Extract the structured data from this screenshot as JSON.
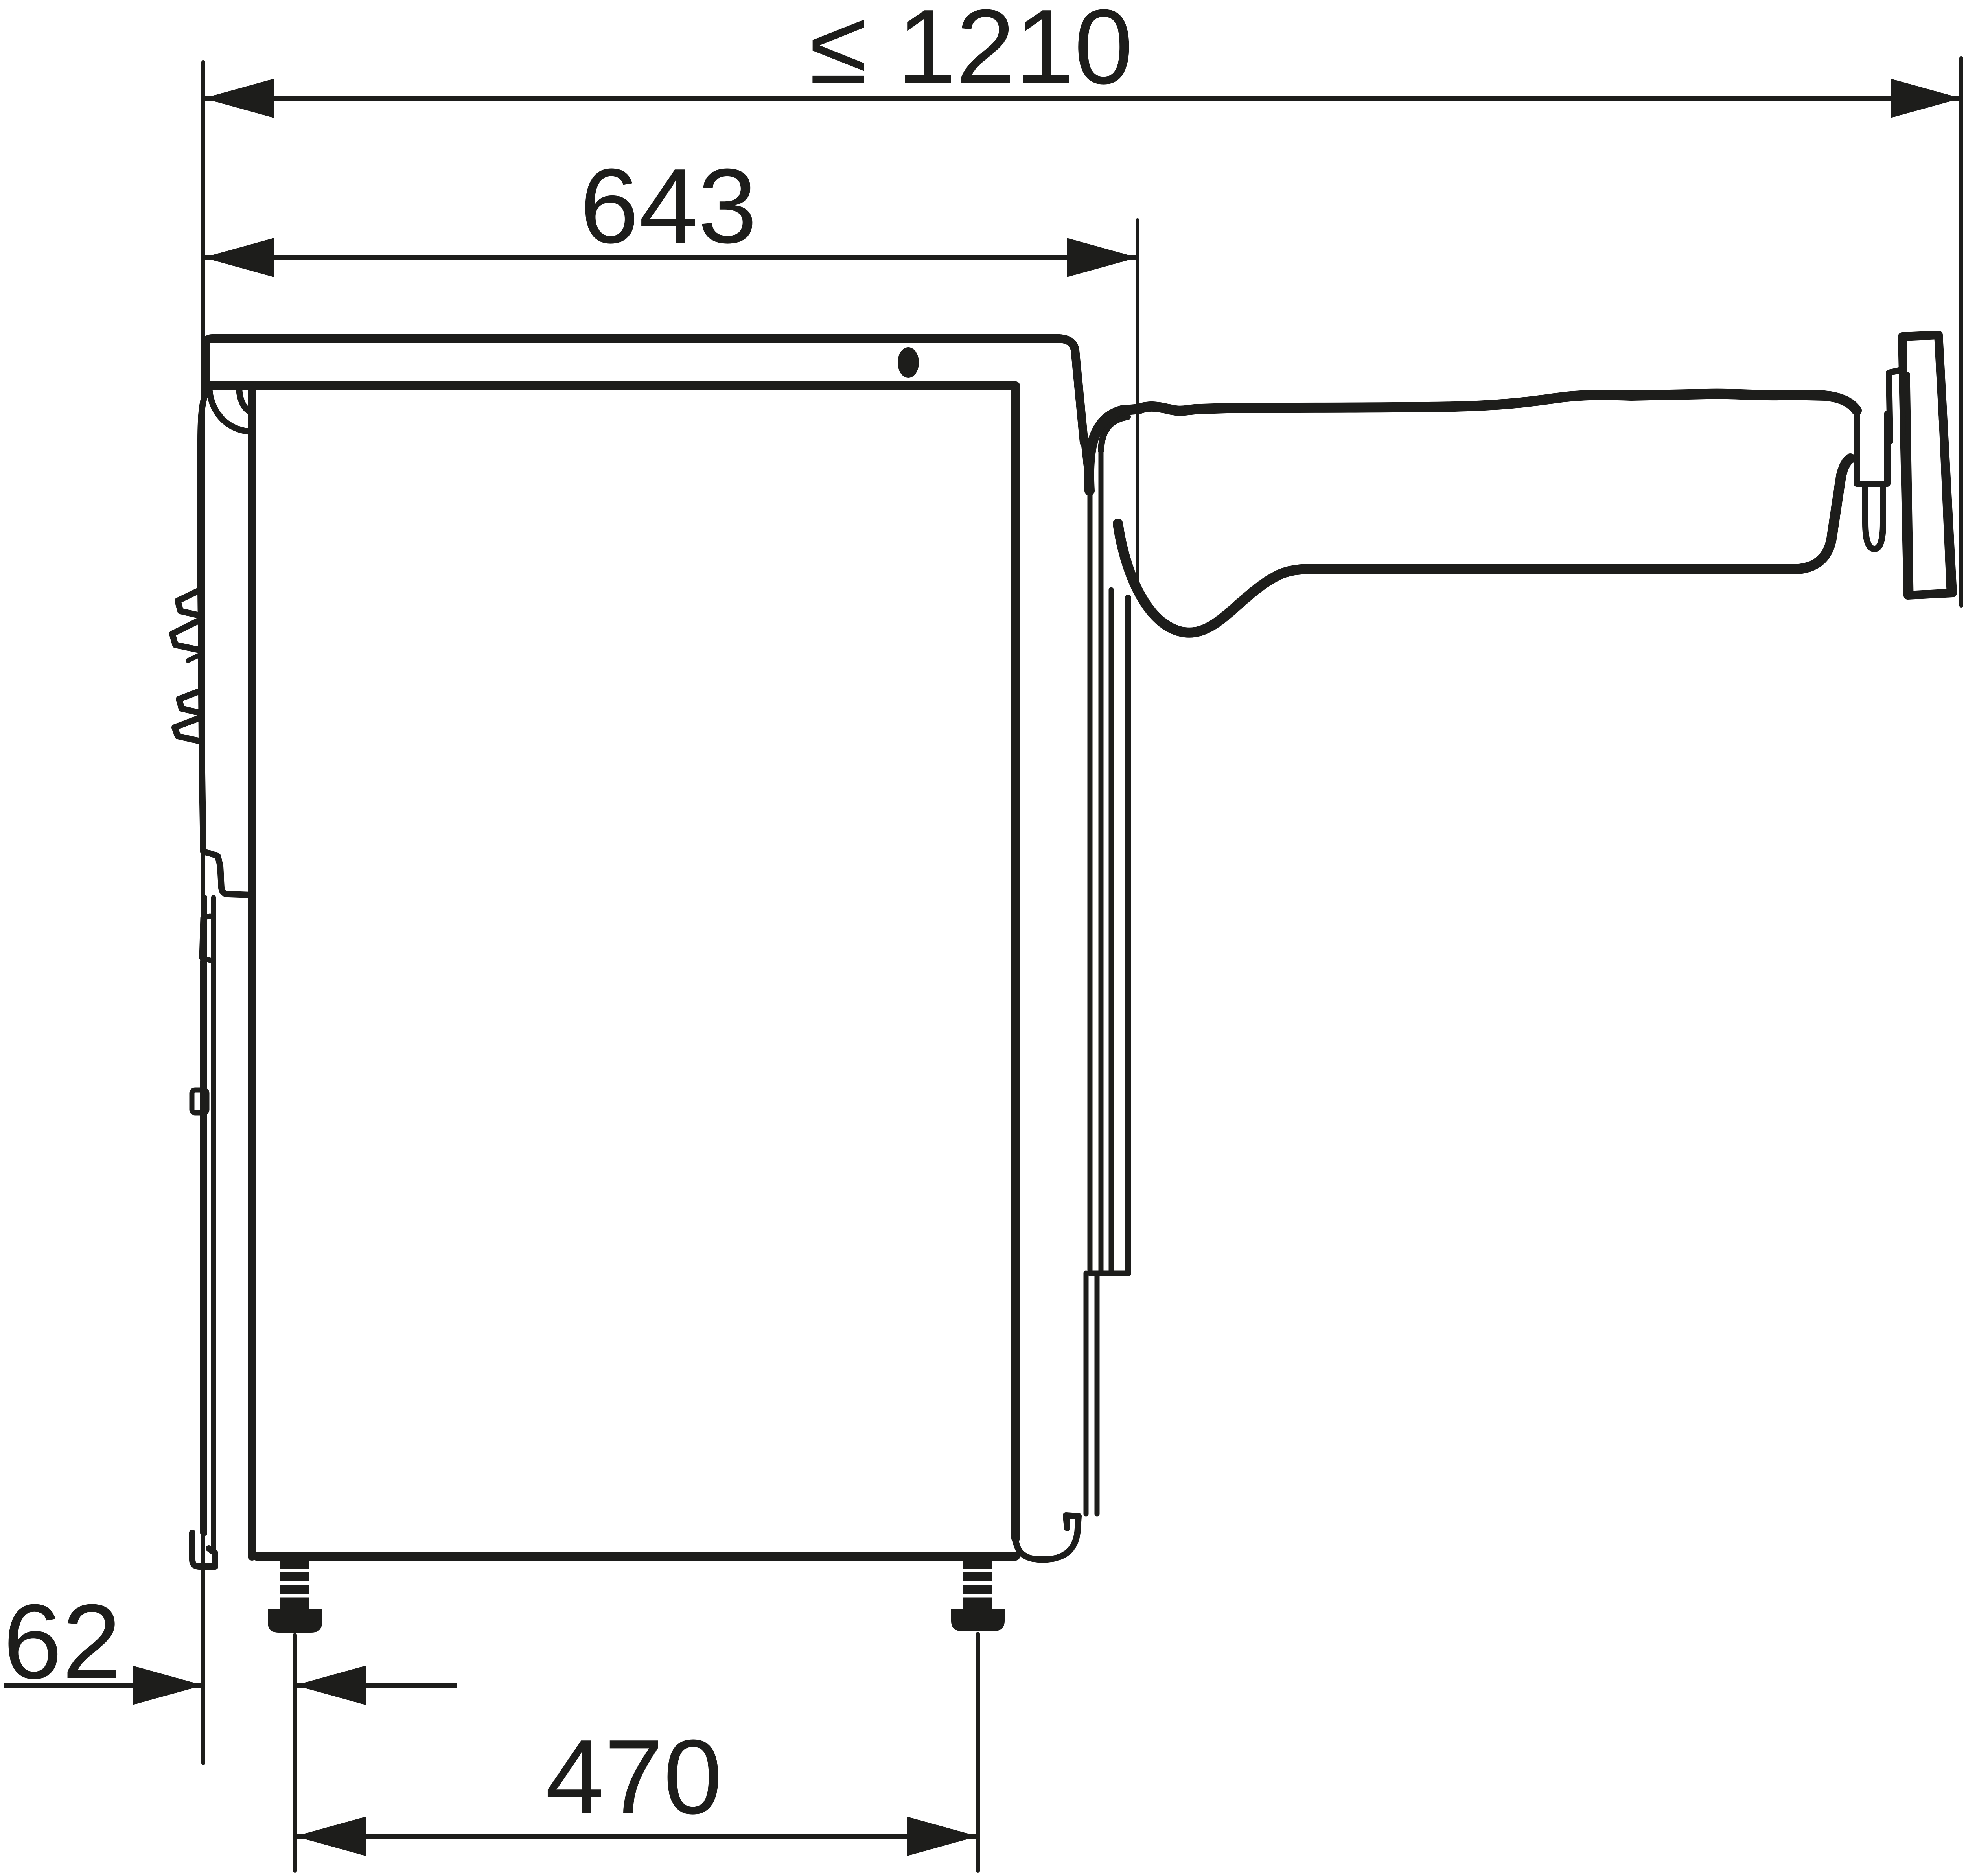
{
  "diagram": {
    "kind": "technical-dimension-drawing",
    "subject": "washing-machine-side-view-with-drain-hose",
    "units": "mm",
    "colors": {
      "ink": "#1d1d1b",
      "background": "#ffffff"
    }
  },
  "dimensions": {
    "overall_depth_with_hose": {
      "label": "≤ 1210",
      "value": 1210,
      "unit": "mm",
      "constraint": "maximum"
    },
    "machine_depth": {
      "label": "643",
      "value": 643,
      "unit": "mm"
    },
    "front_foot_setback": {
      "label": "62",
      "value": 62,
      "unit": "mm"
    },
    "foot_spacing": {
      "label": "470",
      "value": 470,
      "unit": "mm"
    }
  }
}
